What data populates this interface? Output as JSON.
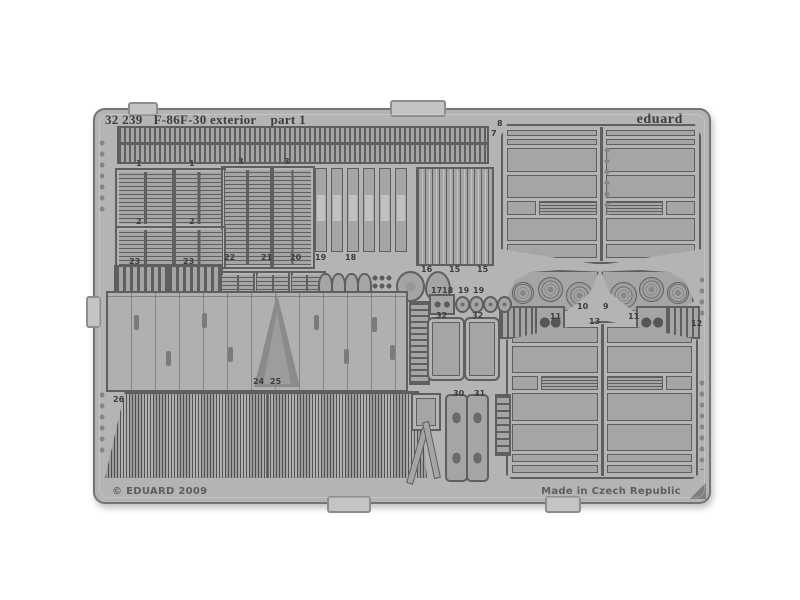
{
  "header": {
    "catalog_number": "32 239",
    "kit_title": "F-86F-30 exterior",
    "part": "part 1",
    "brand": "eduard"
  },
  "footer": {
    "copyright": "© EDUARD 2009",
    "made_in": "Made in Czech Republic"
  },
  "colors": {
    "background": "#ffffff",
    "fret_base": "#b4b4b4",
    "part": "#a5a5a5",
    "part_dark": "#8e8e8e",
    "etch": "#5f5f5f",
    "ink": "#3d3d3d",
    "fret_border": "#747474",
    "tab": "#c4c4c4"
  },
  "part_labels": [
    {
      "text": "1",
      "x": 41,
      "y": 50
    },
    {
      "text": "1",
      "x": 94,
      "y": 50
    },
    {
      "text": "3",
      "x": 143,
      "y": 48
    },
    {
      "text": "3",
      "x": 189,
      "y": 48
    },
    {
      "text": "2",
      "x": 41,
      "y": 108
    },
    {
      "text": "2",
      "x": 94,
      "y": 108
    },
    {
      "text": "7",
      "x": 396,
      "y": 20
    },
    {
      "text": "8",
      "x": 402,
      "y": 10
    },
    {
      "text": "23",
      "x": 34,
      "y": 148
    },
    {
      "text": "23",
      "x": 88,
      "y": 148
    },
    {
      "text": "22",
      "x": 129,
      "y": 144
    },
    {
      "text": "21",
      "x": 166,
      "y": 144
    },
    {
      "text": "20",
      "x": 195,
      "y": 144
    },
    {
      "text": "19",
      "x": 220,
      "y": 144
    },
    {
      "text": "18",
      "x": 250,
      "y": 144
    },
    {
      "text": "16",
      "x": 326,
      "y": 156
    },
    {
      "text": "15",
      "x": 354,
      "y": 156
    },
    {
      "text": "15",
      "x": 382,
      "y": 156
    },
    {
      "text": "17",
      "x": 336,
      "y": 177
    },
    {
      "text": "18",
      "x": 347,
      "y": 177
    },
    {
      "text": "19",
      "x": 363,
      "y": 177
    },
    {
      "text": "19",
      "x": 378,
      "y": 177
    },
    {
      "text": "32",
      "x": 341,
      "y": 202
    },
    {
      "text": "32",
      "x": 377,
      "y": 202
    },
    {
      "text": "30",
      "x": 358,
      "y": 280
    },
    {
      "text": "31",
      "x": 379,
      "y": 280
    },
    {
      "text": "11",
      "x": 455,
      "y": 203
    },
    {
      "text": "11",
      "x": 533,
      "y": 203
    },
    {
      "text": "12",
      "x": 596,
      "y": 210
    },
    {
      "text": "13",
      "x": 494,
      "y": 208
    },
    {
      "text": "10",
      "x": 482,
      "y": 193
    },
    {
      "text": "9",
      "x": 508,
      "y": 193
    },
    {
      "text": "24",
      "x": 158,
      "y": 268
    },
    {
      "text": "25",
      "x": 175,
      "y": 268
    },
    {
      "text": "26",
      "x": 18,
      "y": 286
    }
  ]
}
